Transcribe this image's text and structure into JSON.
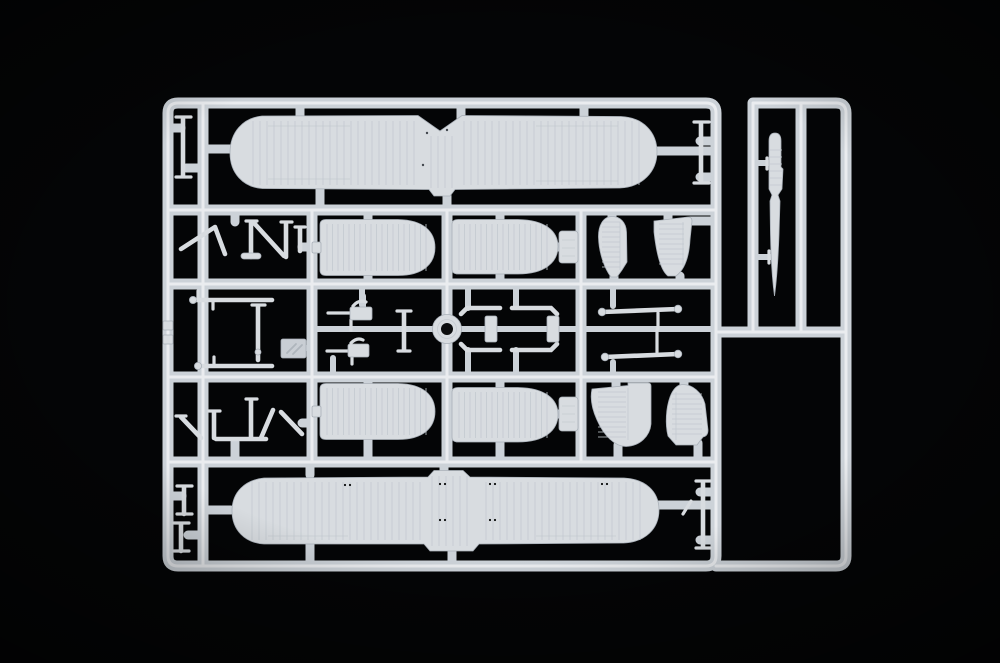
{
  "scene": {
    "type": "photograph",
    "description": "Photograph of a light-grey injection-moulded polystyrene sprue from a biplane model kit, laid on a black background. The rectangular runner frame holds two long one-piece wings, four corrugated float panels, fin and tailplane halves, clusters of slender struts, two machine guns, a gun-ring mount, spreader-bar rods and, on a narrow side runner, a long blade-shaped keel part."
  },
  "colors": {
    "background": "#040506",
    "plastic": "#d8dce0",
    "plastic_dark": "#c9ced4",
    "rail": "#ccd2d8",
    "rail_highlight": "#eef1f3",
    "rib": "#c3c9cf",
    "shadow": "#a9b0b8",
    "hole": "#0c0d0e",
    "speck": "#43484e"
  },
  "parts": {
    "sprue_frame": "Sprue runner frame",
    "upper_wing": "Upper wing, one-piece with centre notch",
    "lower_wing": "Lower wing, one-piece with centre tab",
    "float_panel_1": "Corrugated float panel (upper left)",
    "float_panel_2": "Corrugated float panel (upper right)",
    "float_panel_3": "Corrugated float panel (lower left)",
    "float_panel_4": "Corrugated float panel (lower right)",
    "fin_a": "Rounded fin half (upper row)",
    "fin_b": "Tapered tailplane half (upper row)",
    "fin_c": "Tapered tailplane half (lower row)",
    "fin_d": "Rounded fin half (lower row)",
    "strut_cluster_upper": "Cabane strut cluster (upper)",
    "strut_cluster_lower": "Cabane strut cluster (lower)",
    "machine_guns": "Machine guns",
    "gun_ring": "Gun-ring mount",
    "spreader_rods": "Spreader-bar rods",
    "step_rods": "Stepped strut rods",
    "long_strut_rods": "Long interplane strut rods",
    "part_tag": "Moulded identification tag",
    "keel_blade": "Blade-shaped float keel on side runner",
    "small_struts": "Small single struts"
  }
}
